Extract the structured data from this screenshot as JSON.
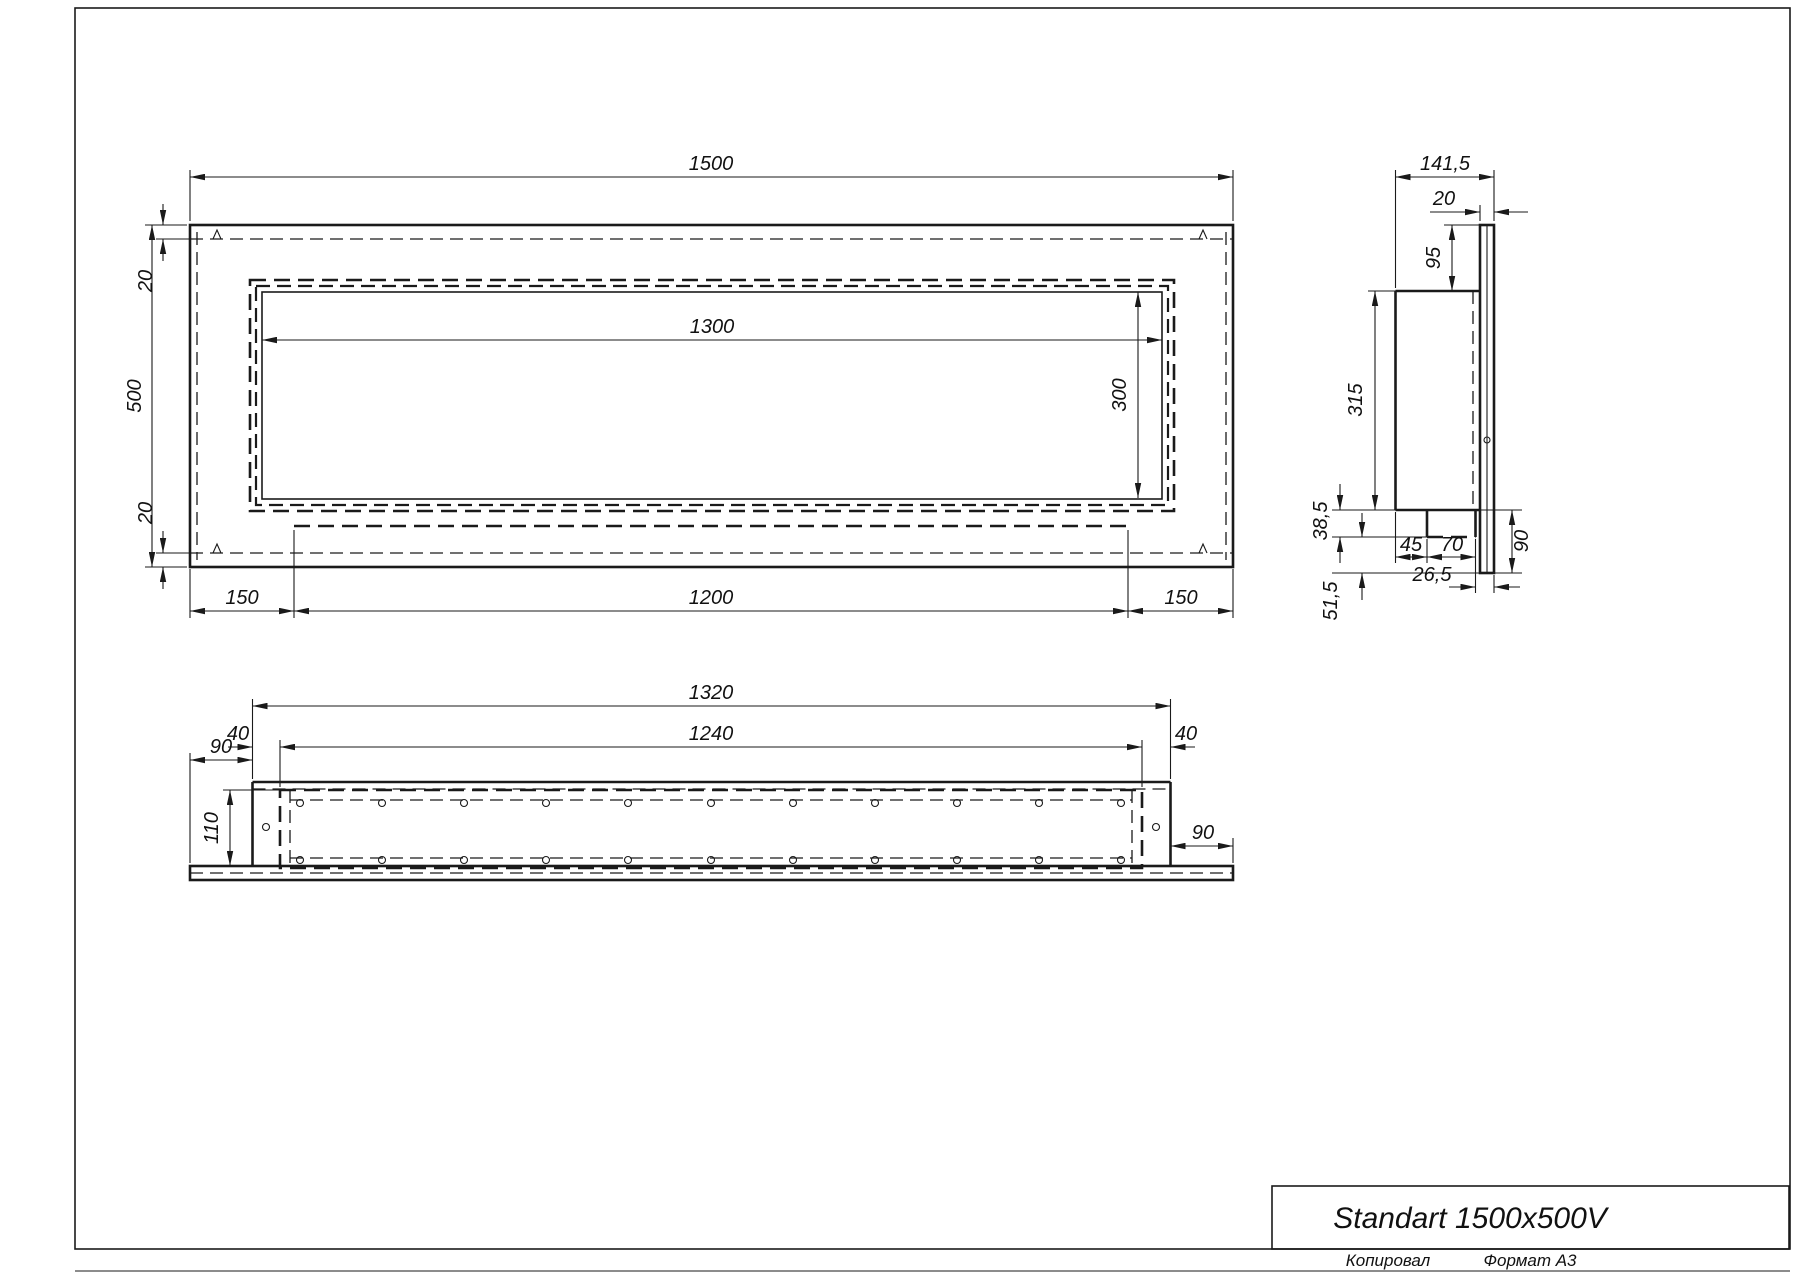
{
  "drawing": {
    "title": "Standart 1500x500V",
    "footer": {
      "copy_label": "Копировал",
      "format_label": "Формат А3"
    },
    "front_view": {
      "dims": {
        "overall_width": "1500",
        "overall_height": "500",
        "top_margin": "20",
        "bottom_margin": "20",
        "opening_width": "1300",
        "opening_height": "300",
        "bottom_left_offset": "150",
        "bottom_tray_width": "1200",
        "bottom_right_offset": "150"
      }
    },
    "side_view": {
      "dims": {
        "overall_depth": "141,5",
        "flange_thickness": "20",
        "top_to_body": "95",
        "body_height": "315",
        "tray_drop": "38,5",
        "tray_offset": "45",
        "tray_depth": "70",
        "below_body": "90",
        "tray_to_front": "26,5",
        "tray_to_flange_bottom": "51,5"
      }
    },
    "bottom_view": {
      "dims": {
        "body_width": "1320",
        "opening_width": "1240",
        "left_margin": "40",
        "right_margin": "40",
        "flange_left": "90",
        "flange_right": "90",
        "opening_depth": "110"
      }
    }
  }
}
